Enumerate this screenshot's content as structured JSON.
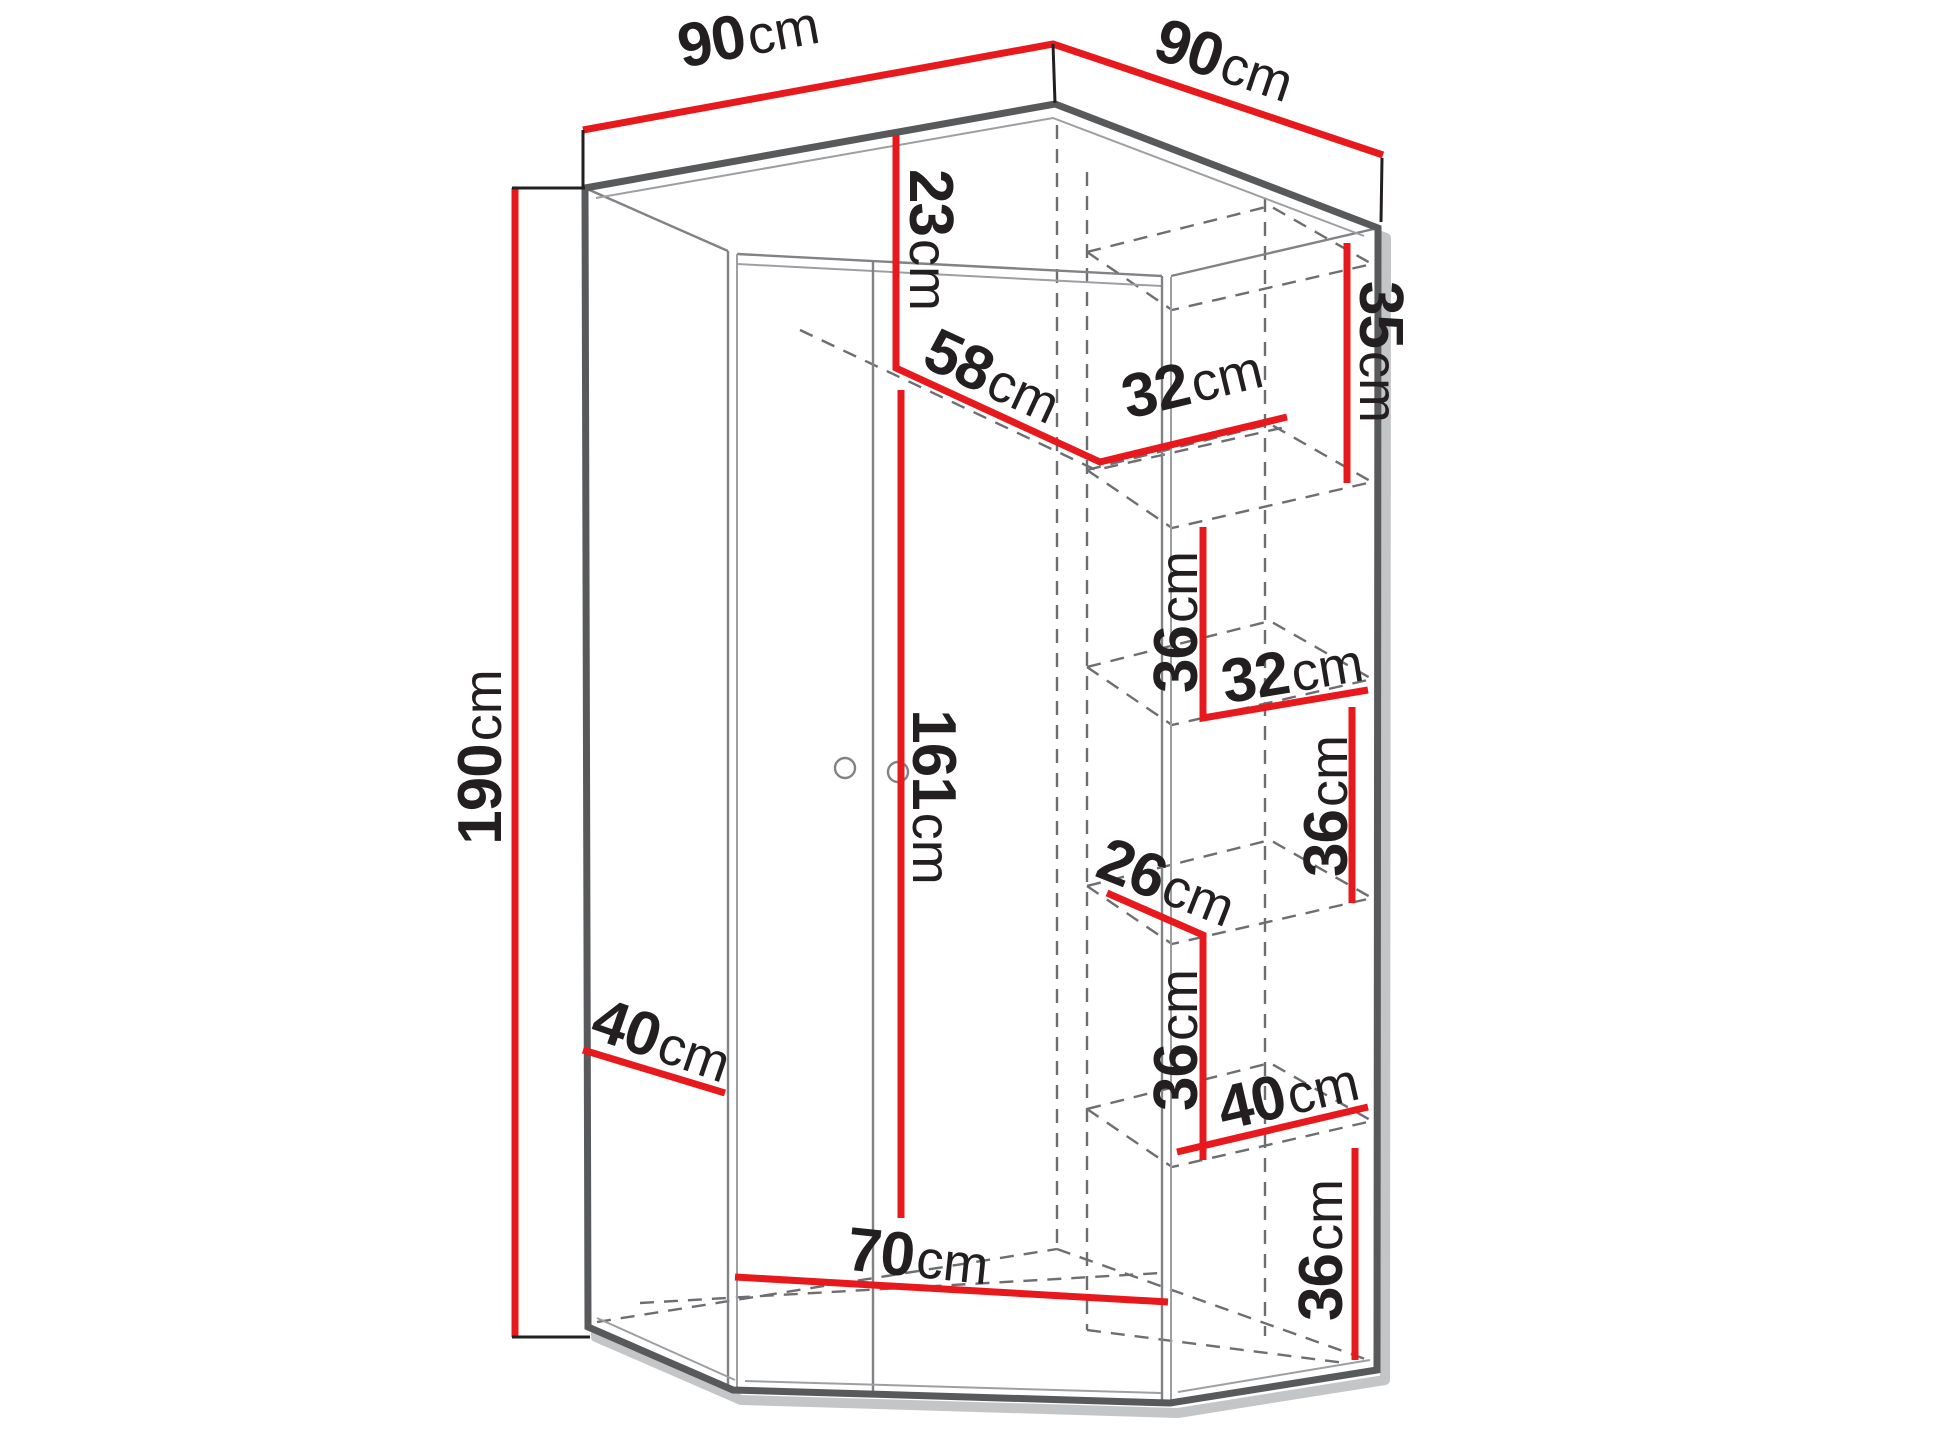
{
  "title": "Corner wardrobe dimension diagram",
  "unit_default": "cm",
  "colors": {
    "dimension_line": "#e8191d",
    "body_outline": "#58595b",
    "panel_line": "#808285",
    "hidden_line": "#6d6e71",
    "label_text": "#231f20",
    "background": "#ffffff"
  },
  "dimensions": {
    "top_left_width": {
      "num": "90",
      "unit": "cm"
    },
    "top_right_width": {
      "num": "90",
      "unit": "cm"
    },
    "total_height": {
      "num": "190",
      "unit": "cm"
    },
    "top_inset_height": {
      "num": "23",
      "unit": "cm"
    },
    "interior_front_width": {
      "num": "58",
      "unit": "cm"
    },
    "upper_shelf_depth": {
      "num": "32",
      "unit": "cm"
    },
    "upper_right_height": {
      "num": "35",
      "unit": "cm"
    },
    "shelf_gap_upper": {
      "num": "36",
      "unit": "cm"
    },
    "middle_shelf_depth": {
      "num": "32",
      "unit": "cm"
    },
    "shelf_gap_middle_upper": {
      "num": "36",
      "unit": "cm"
    },
    "lower_shelf_clearance": {
      "num": "26",
      "unit": "cm"
    },
    "shelf_gap_middle_lower": {
      "num": "36",
      "unit": "cm"
    },
    "lower_shelf_width": {
      "num": "40",
      "unit": "cm"
    },
    "shelf_gap_lower": {
      "num": "36",
      "unit": "cm"
    },
    "door_height": {
      "num": "161",
      "unit": "cm"
    },
    "side_panel_width": {
      "num": "40",
      "unit": "cm"
    },
    "front_panel_width": {
      "num": "70",
      "unit": "cm"
    }
  }
}
